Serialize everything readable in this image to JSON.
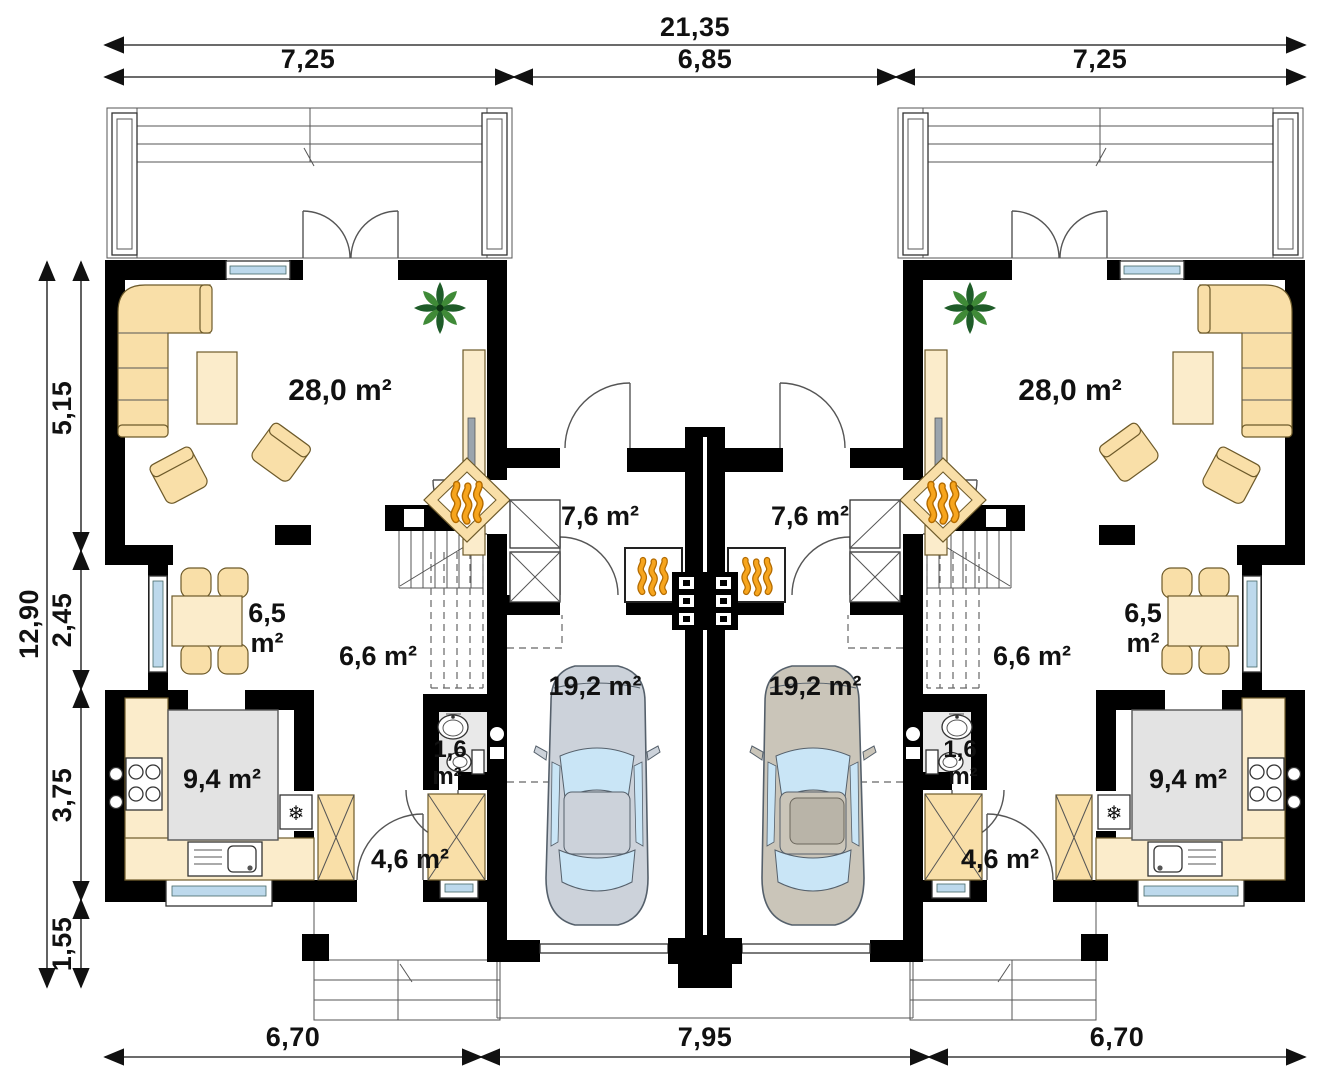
{
  "title": "duplex-ground-floor-plan",
  "dimensions": {
    "top_total": "21,35",
    "top_left": "7,25",
    "top_middle": "6,85",
    "top_right": "7,25",
    "side_total": "12,90",
    "side_1": "5,15",
    "side_2": "2,45",
    "side_3": "3,75",
    "side_4": "1,55",
    "bottom_left": "6,70",
    "bottom_middle": "7,95",
    "bottom_right": "6,70"
  },
  "rooms_left": {
    "living_area": "28,0 m²",
    "dining_value": "6,5",
    "dining_unit": "m²",
    "hall_area": "6,6 m²",
    "vestibule_area": "7,6 m²",
    "garage_area": "19,2 m²",
    "kitchen_area": "9,4 m²",
    "wc_value": "1,6",
    "wc_unit": "m²",
    "corridor_area": "4,6 m²"
  },
  "rooms_right": {
    "living_area": "28,0 m²",
    "dining_value": "6,5",
    "dining_unit": "m²",
    "hall_area": "6,6 m²",
    "vestibule_area": "7,6 m²",
    "garage_area": "19,2 m²",
    "kitchen_area": "9,4 m²",
    "wc_value": "1,6",
    "wc_unit": "m²",
    "corridor_area": "4,6 m²"
  },
  "icons": {
    "fridge_snowflake": "❄"
  },
  "colors": {
    "paper": "#ffffff",
    "wall": "#000000",
    "line": "#555555",
    "furniture_fill": "#f9dfa8",
    "furniture_light": "#fbeccb",
    "island_fill": "#e3e3e3",
    "floor_gray": "#e9e9e9",
    "glass": "#bdd9ec",
    "flame": "#f7a51d",
    "flame_dark": "#b36b00",
    "plant_dark": "#1e5c28",
    "plant_light": "#3f8a37",
    "car_left": "#ccd2da",
    "car_right": "#cac5b9",
    "car_glass": "#c9e5f6"
  }
}
